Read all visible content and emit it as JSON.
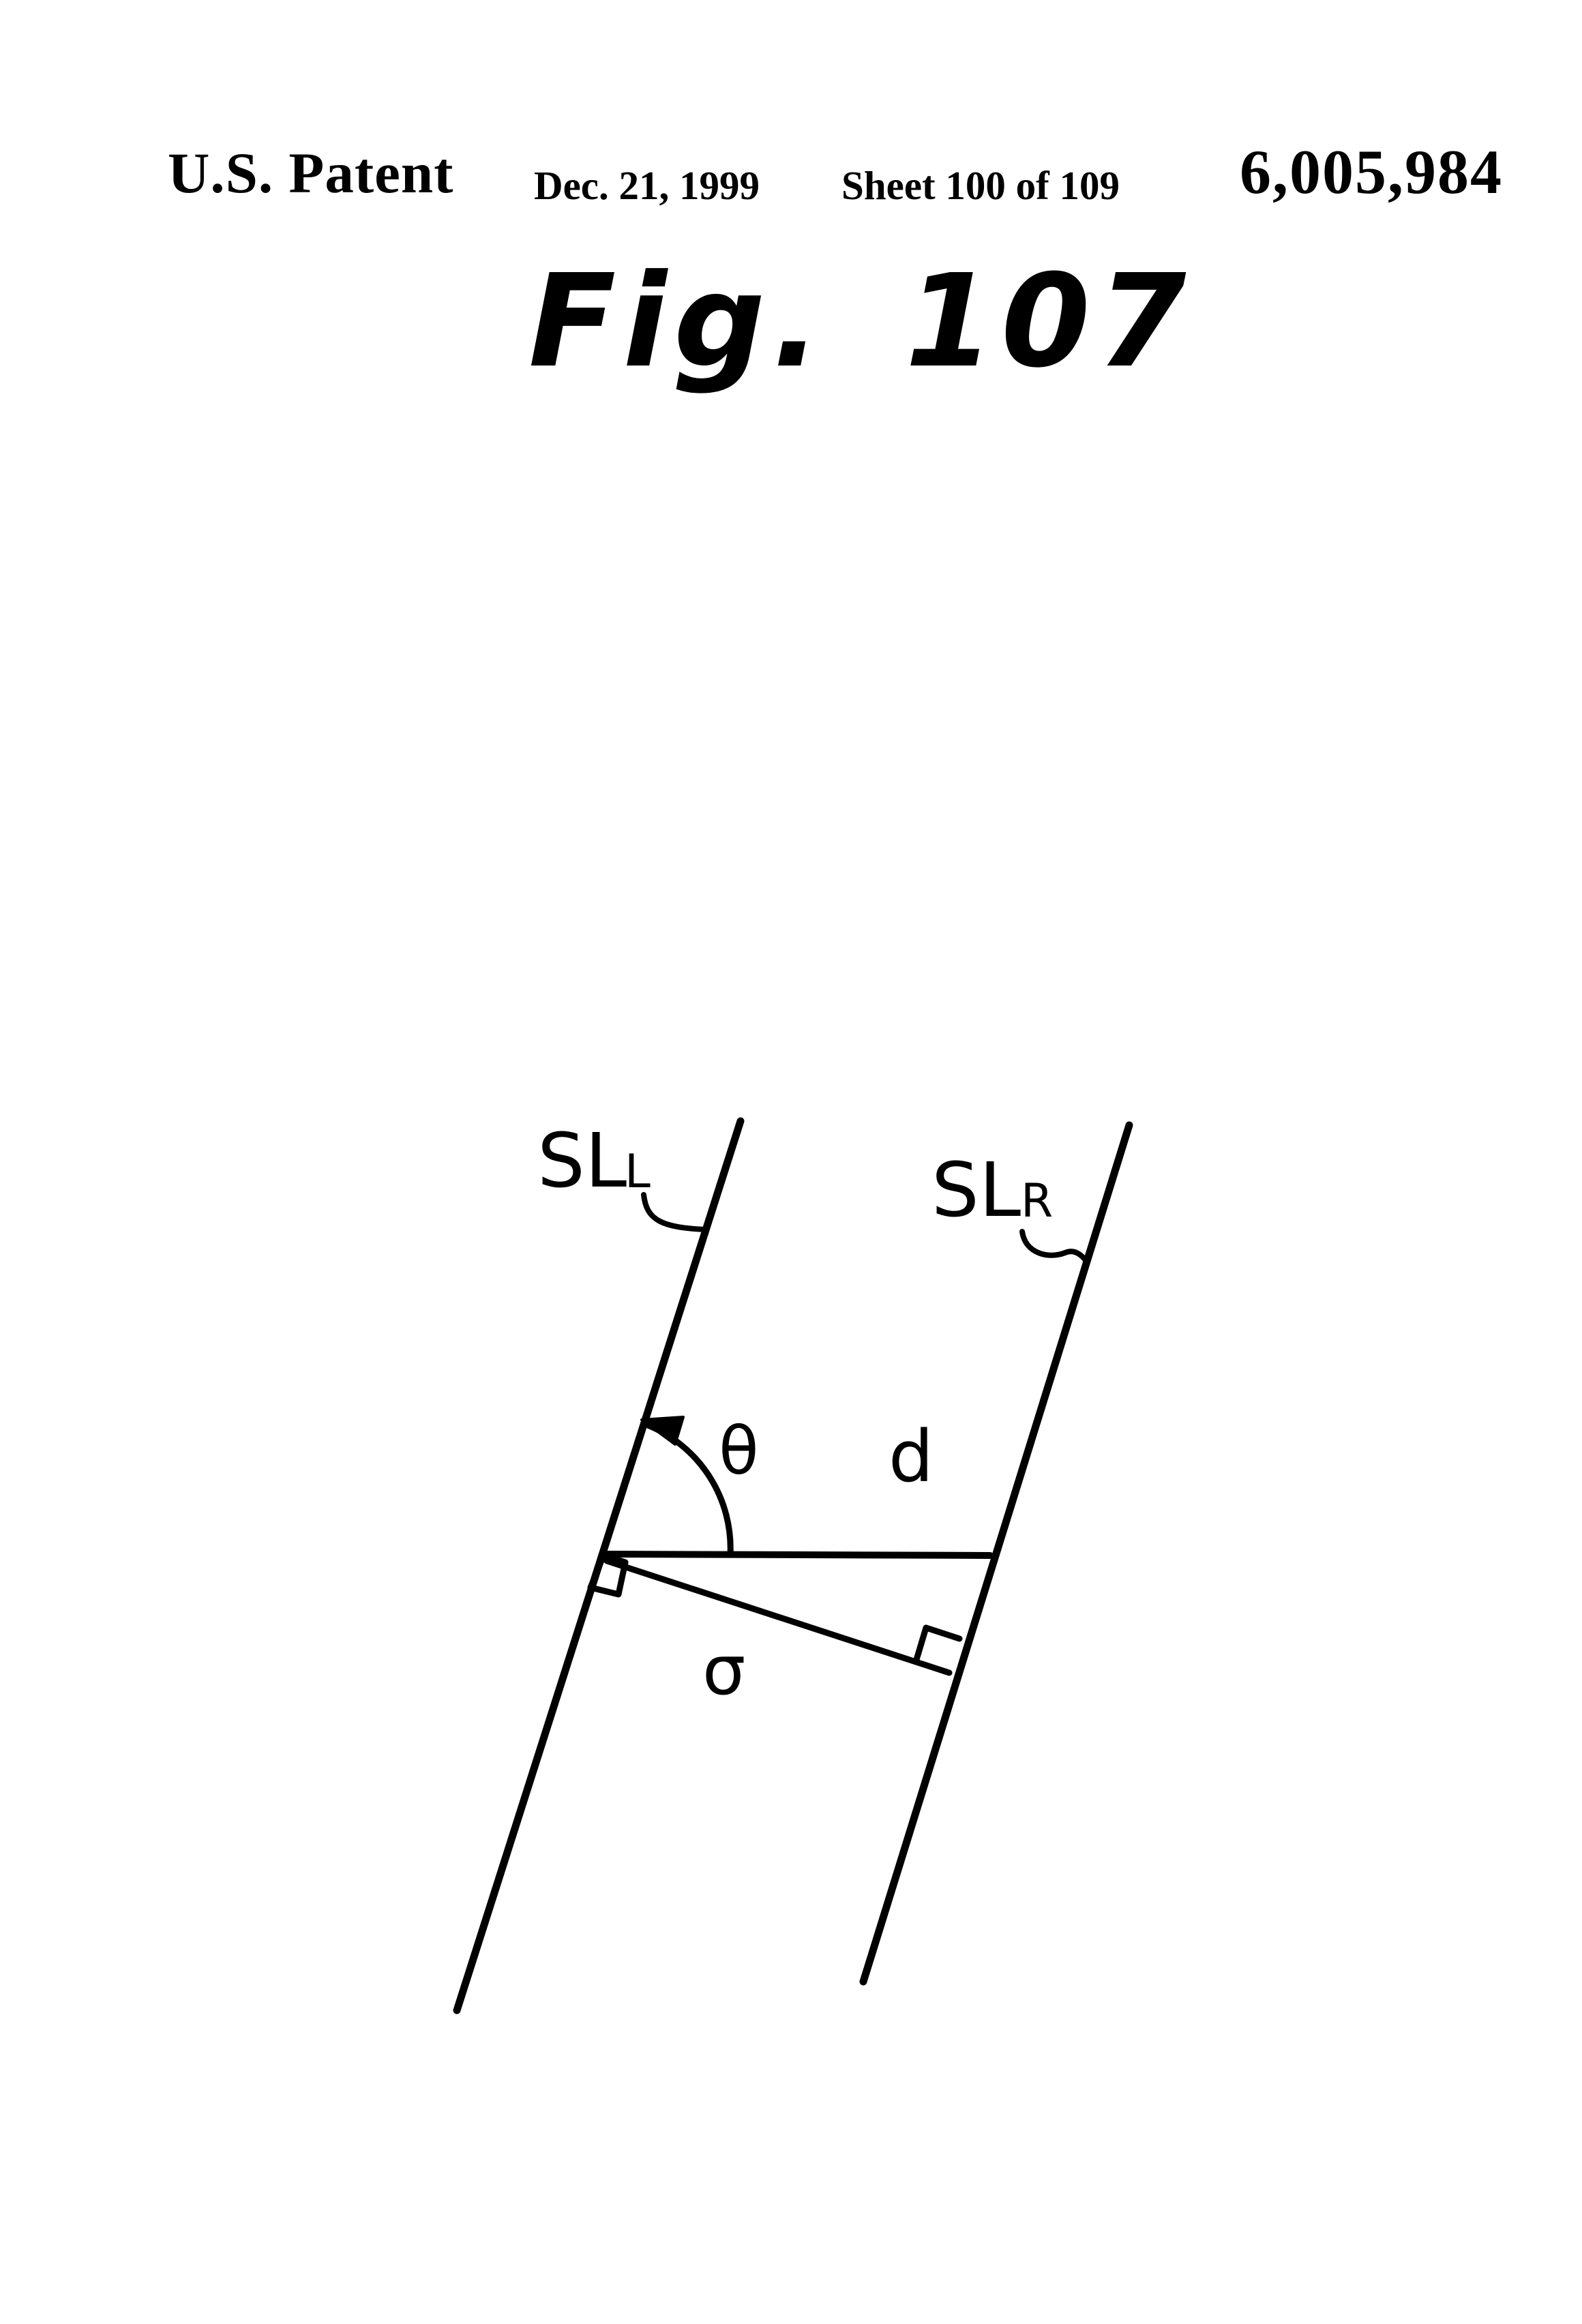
{
  "header": {
    "title": "U.S. Patent",
    "date": "Dec. 21, 1999",
    "sheet": "Sheet 100 of 109",
    "patent_number": "6,005,984"
  },
  "figure": {
    "caption": "Fig. 107",
    "labels": {
      "left_scan_line_main": "SL",
      "left_scan_line_sub": "L",
      "right_scan_line_main": "SL",
      "right_scan_line_sub": "R",
      "angle": "θ",
      "horizontal_distance": "d",
      "perpendicular_distance": "σ"
    }
  },
  "colors": {
    "ink": "#000000",
    "paper": "#ffffff"
  }
}
